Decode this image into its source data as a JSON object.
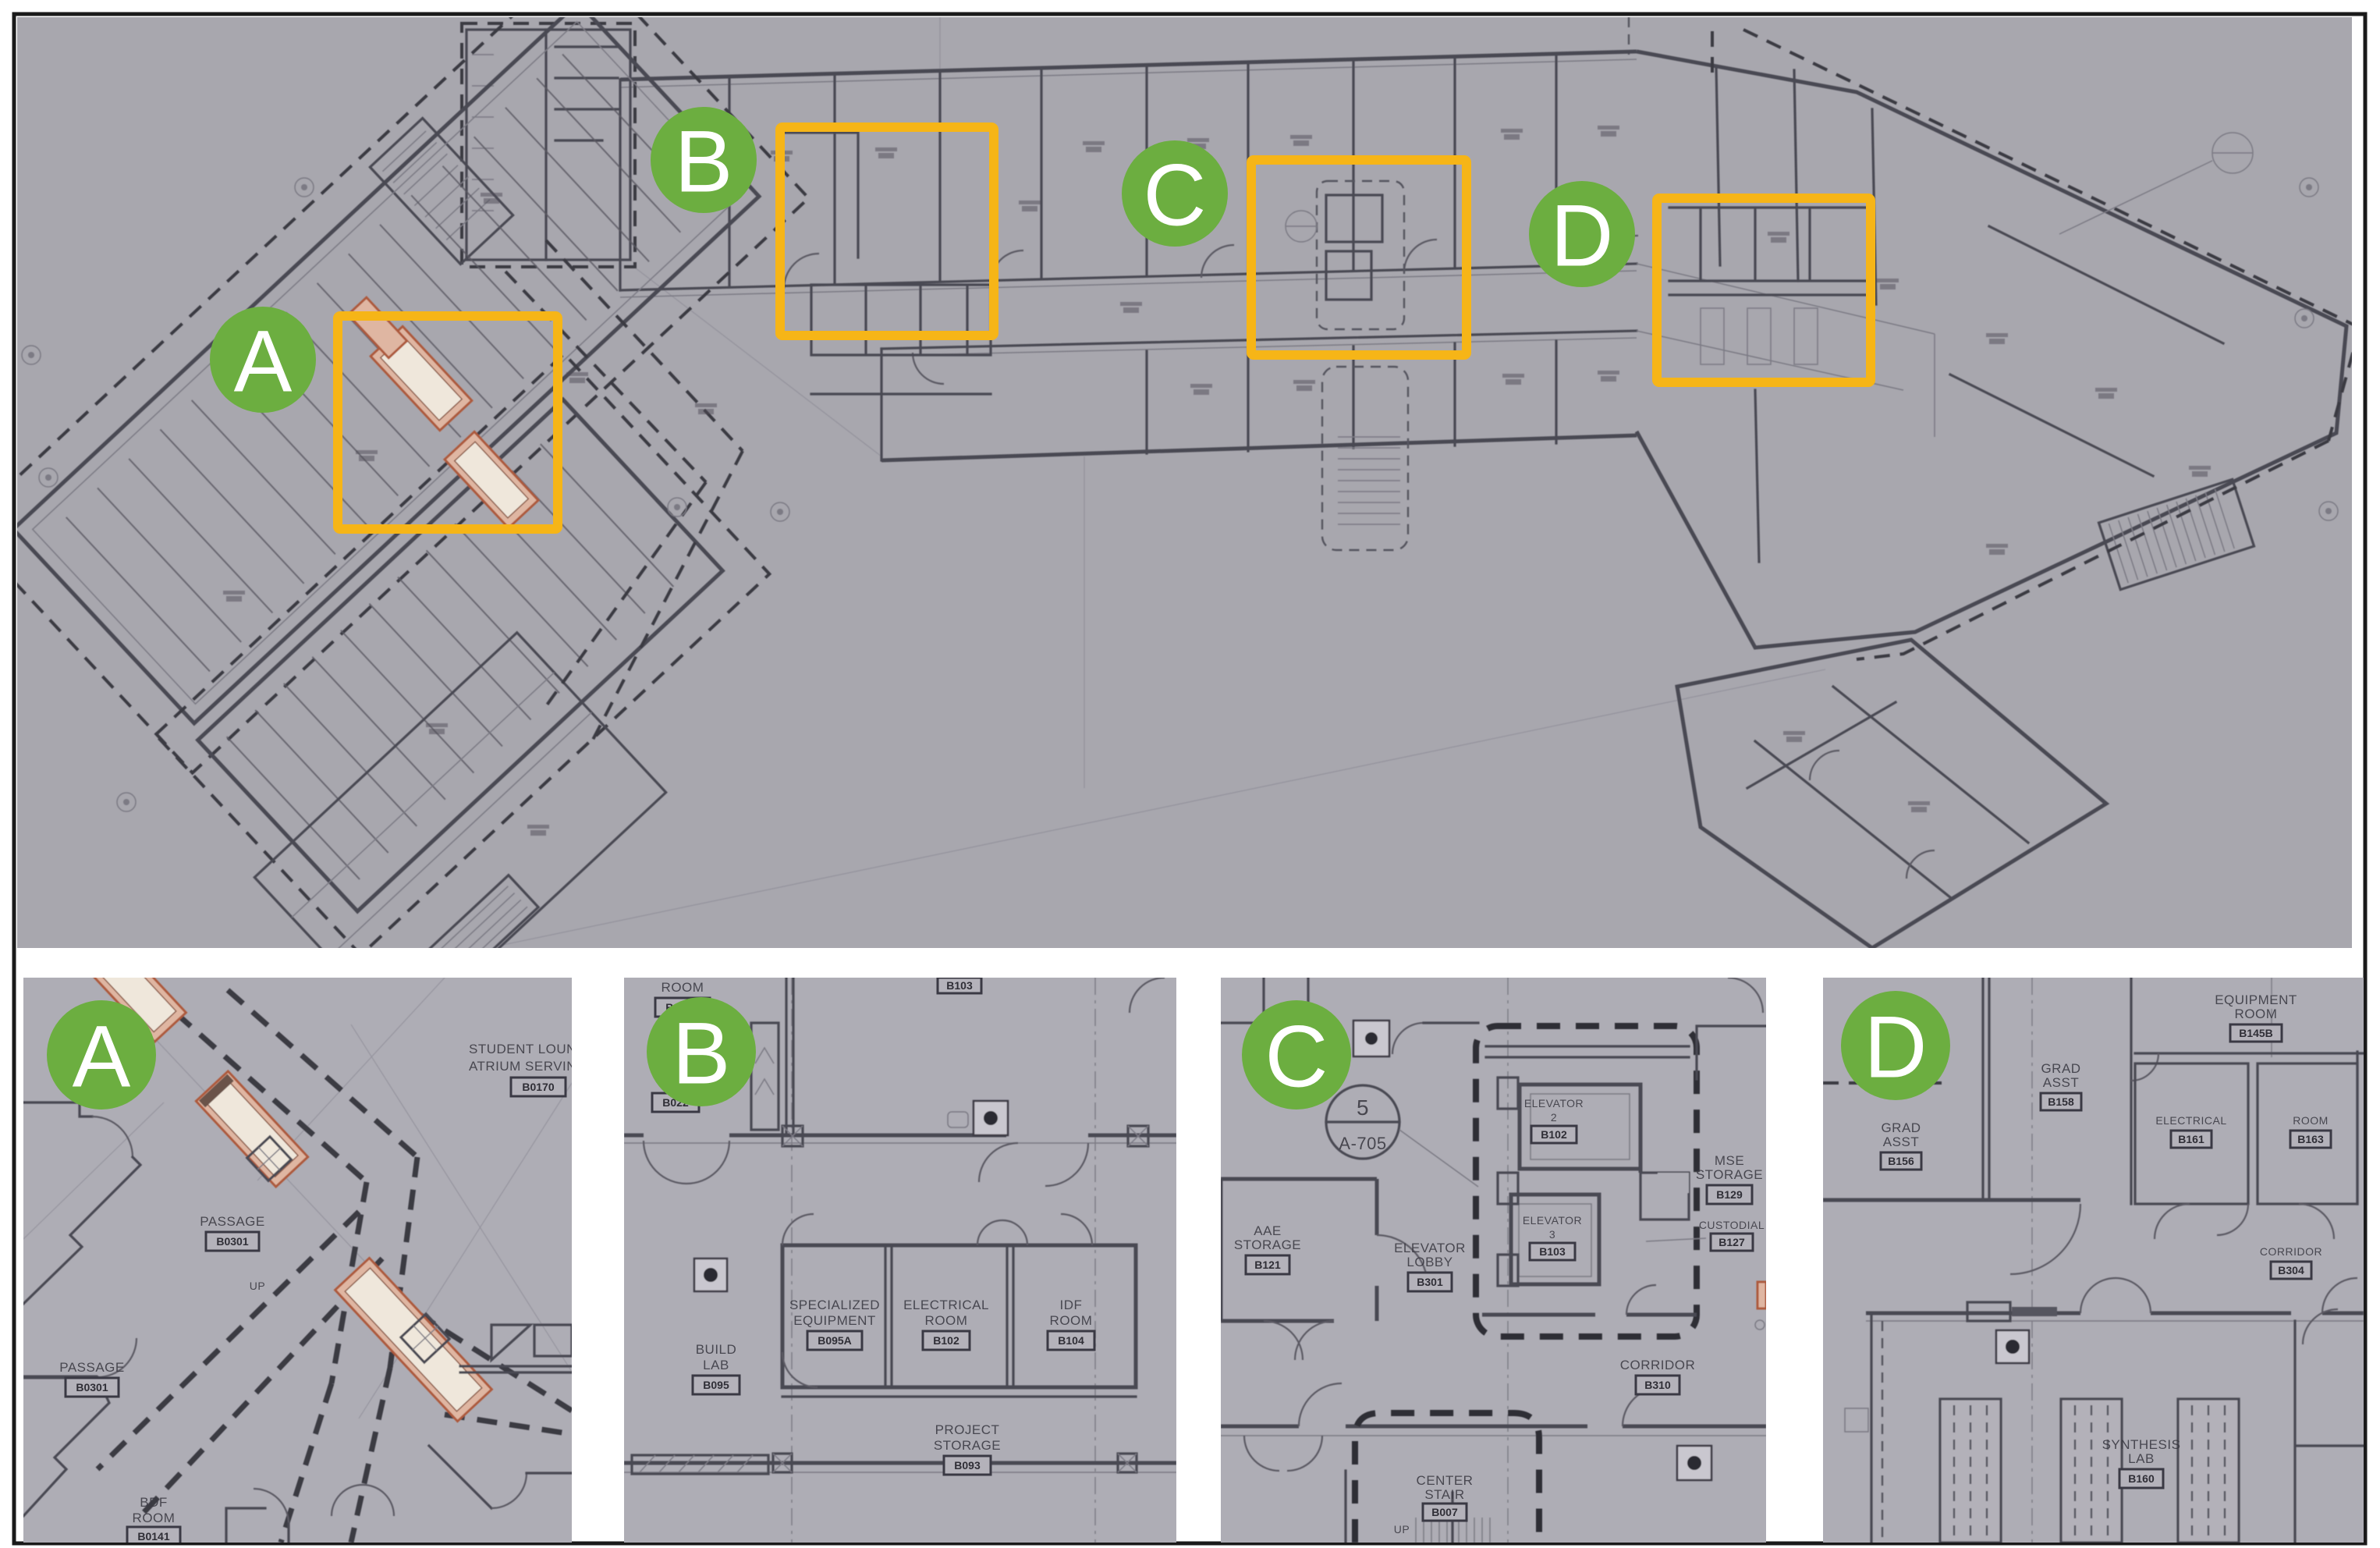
{
  "colors": {
    "marker_green": "#6cae40",
    "highlight_yellow": "#f6b517",
    "photo_background": "#a8a7ae",
    "panel_background": "#aeadb5",
    "wall_line": "#4a4952",
    "heavy_dash": "#2f2e36",
    "ramp_fill": "#dfb6a2",
    "ramp_stroke": "#ad5a3d"
  },
  "overview": {
    "regions": [
      {
        "letter": "A"
      },
      {
        "letter": "B"
      },
      {
        "letter": "C"
      },
      {
        "letter": "D"
      }
    ]
  },
  "panel_a": {
    "letter": "A",
    "student_lounge_line1": "STUDENT LOUN",
    "student_lounge_line2": "ATRIUM SERVIN",
    "student_lounge_tag": "B0170",
    "passage_upper": "PASSAGE",
    "passage_upper_tag": "B0301",
    "passage_lower": "PASSAGE",
    "passage_lower_tag": "B0301",
    "up_label": "UP",
    "bdf_line1": "BDF",
    "bdf_line2": "ROOM",
    "bdf_tag": "B0141"
  },
  "panel_b": {
    "letter": "B",
    "room_top": "ROOM",
    "room_top_tag": "B022A",
    "room_up_tag": "B022",
    "top_cut_tag": "B103",
    "spec_line1": "SPECIALIZED",
    "spec_line2": "EQUIPMENT",
    "spec_tag": "B095A",
    "electrical_line1": "ELECTRICAL",
    "electrical_line2": "ROOM",
    "electrical_tag": "B102",
    "idf_line1": "IDF",
    "idf_line2": "ROOM",
    "idf_tag": "B104",
    "build_line1": "BUILD",
    "build_line2": "LAB",
    "build_tag": "B095",
    "project_line1": "PROJECT",
    "project_line2": "STORAGE",
    "project_tag": "B093"
  },
  "panel_c": {
    "letter": "C",
    "callout_top": "5",
    "callout_bottom": "A-705",
    "elev2_line1": "ELEVATOR",
    "elev2_num": "2",
    "elev2_tag": "B102",
    "elev3_line1": "ELEVATOR",
    "elev3_num": "3",
    "elev3_tag": "B103",
    "mse_line1": "MSE",
    "mse_line2": "STORAGE",
    "mse_tag": "B129",
    "custodial": "CUSTODIAL",
    "custodial_tag": "B127",
    "aae_line1": "AAE",
    "aae_line2": "STORAGE",
    "aae_tag": "B121",
    "lobby_line1": "ELEVATOR",
    "lobby_line2": "LOBBY",
    "lobby_tag": "B301",
    "corridor": "CORRIDOR",
    "corridor_tag": "B310",
    "stair_line1": "CENTER",
    "stair_line2": "STAIR",
    "stair_tag": "B007",
    "up_label": "UP"
  },
  "panel_d": {
    "letter": "D",
    "grad1_line1": "GRAD",
    "grad1_line2": "ASST",
    "grad1_tag": "B156",
    "grad2_line1": "GRAD",
    "grad2_line2": "ASST",
    "grad2_tag": "B158",
    "equip_line1": "EQUIPMENT",
    "equip_line2": "ROOM",
    "equip_tag": "B145B",
    "electrical": "ELECTRICAL",
    "electrical_tag": "B161",
    "room_right": "ROOM",
    "room_right_tag": "B163",
    "corridor": "CORRIDOR",
    "corridor_tag": "B304",
    "synth_line1": "SYNTHESIS",
    "synth_line2": "LAB",
    "synth_tag": "B160"
  }
}
